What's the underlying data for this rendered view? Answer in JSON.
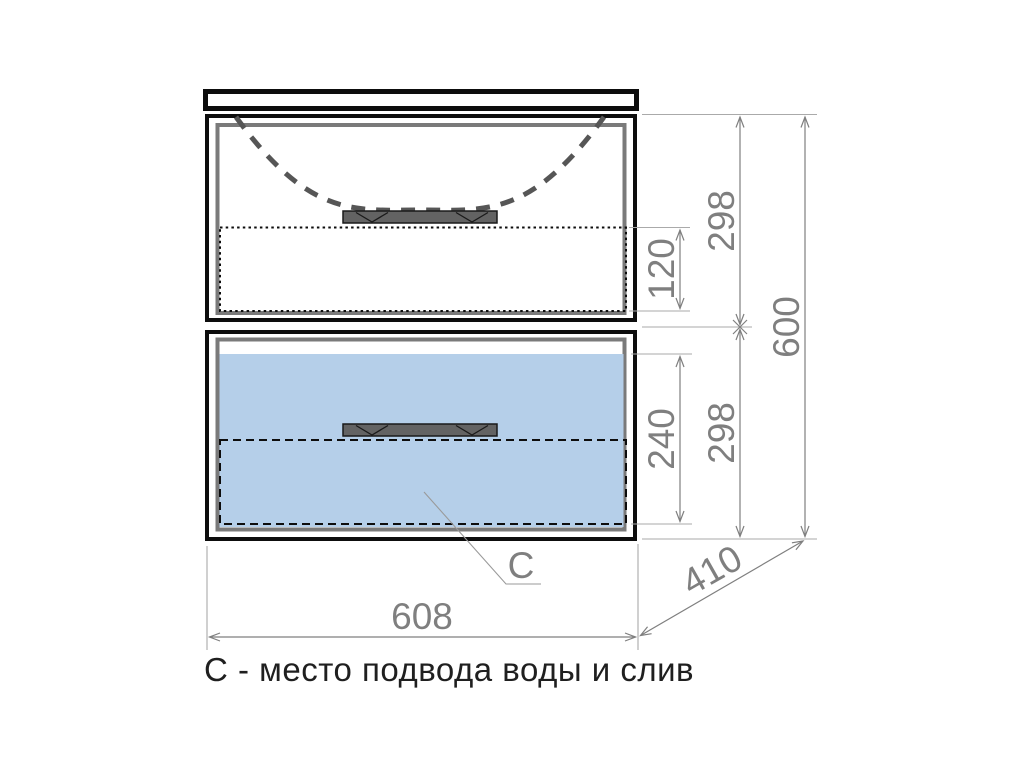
{
  "drawing": {
    "kind": "furniture-dimension-drawing",
    "dimensions": {
      "overall_width": "608",
      "overall_height": "600",
      "depth": "410",
      "top_drawer_height": "298",
      "top_drawer_inner_height": "120",
      "bottom_drawer_height": "298",
      "bottom_drawer_inner_height": "240"
    },
    "callout": {
      "label": "С"
    },
    "caption": {
      "text": "С - место подвода воды и слив"
    }
  },
  "colors": {
    "outline_black": "#0d0d0d",
    "panel_gray": "#7a7a7a",
    "dimension_gray": "#7f7f7f",
    "extension_gray": "#aaaaaa",
    "handle_gray": "#636363",
    "handle_edge": "#1a1a1a",
    "water_zone_blue": "#b5cfe9",
    "sink_outline_gray": "#565656",
    "leader_gray": "#9a9a9a",
    "caption_dark": "#1f1f1f",
    "page_bg": "#ffffff"
  }
}
